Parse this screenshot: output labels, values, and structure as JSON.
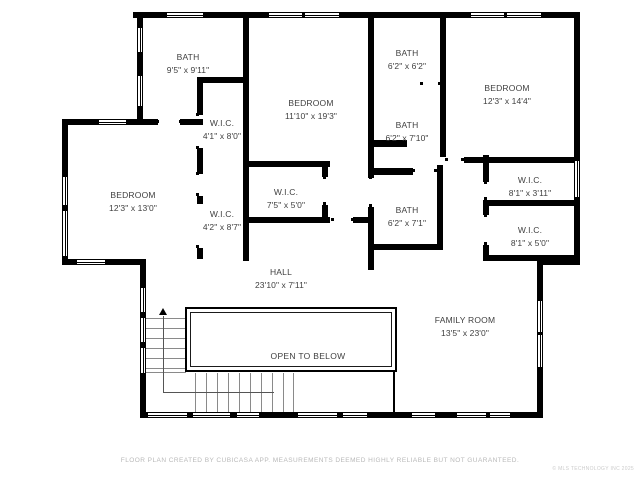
{
  "title": "Second floor plan",
  "colors": {
    "background": "#ffffff",
    "wall": "#000000",
    "label_text": "#3f3f3f",
    "footer_text": "#b9b9b9"
  },
  "rooms": [
    {
      "name": "BATH",
      "dims": "9'5\" x 9'11\"",
      "cx": 188,
      "cy": 64
    },
    {
      "name": "W.I.C.",
      "dims": "4'1\" x 8'0\"",
      "cx": 222,
      "cy": 130
    },
    {
      "name": "BEDROOM",
      "dims": "11'10\" x 19'3\"",
      "cx": 311,
      "cy": 110
    },
    {
      "name": "BATH",
      "dims": "6'2\" x 6'2\"",
      "cx": 407,
      "cy": 60
    },
    {
      "name": "BATH",
      "dims": "6'2\" x 7'10\"",
      "cx": 407,
      "cy": 132
    },
    {
      "name": "BEDROOM",
      "dims": "12'3\" x 14'4\"",
      "cx": 507,
      "cy": 95
    },
    {
      "name": "BEDROOM",
      "dims": "12'3\" x 13'0\"",
      "cx": 133,
      "cy": 202
    },
    {
      "name": "W.I.C.",
      "dims": "4'2\" x 8'7\"",
      "cx": 222,
      "cy": 221
    },
    {
      "name": "W.I.C.",
      "dims": "7'5\" x 5'0\"",
      "cx": 286,
      "cy": 199
    },
    {
      "name": "BATH",
      "dims": "6'2\" x 7'1\"",
      "cx": 407,
      "cy": 217
    },
    {
      "name": "W.I.C.",
      "dims": "8'1\" x 3'11\"",
      "cx": 530,
      "cy": 187
    },
    {
      "name": "W.I.C.",
      "dims": "8'1\" x 5'0\"",
      "cx": 530,
      "cy": 237
    },
    {
      "name": "HALL",
      "dims": "23'10\" x 7'11\"",
      "cx": 281,
      "cy": 279
    },
    {
      "name": "FAMILY ROOM",
      "dims": "13'5\" x 23'0\"",
      "cx": 465,
      "cy": 327
    }
  ],
  "open_to_below": {
    "label": "OPEN TO BELOW",
    "cx": 308,
    "cy": 356
  },
  "footer": {
    "disclaimer": "FLOOR PLAN CREATED BY CUBICASA APP. MEASUREMENTS DEEMED HIGHLY RELIABLE BUT NOT GUARANTEED.",
    "copyright": "© MLS TECHNOLOGY INC 2025"
  },
  "plan": {
    "walls": [
      [
        133,
        12,
        447,
        6
      ],
      [
        574,
        12,
        6,
        253
      ],
      [
        537,
        259,
        43,
        6
      ],
      [
        537,
        259,
        6,
        159
      ],
      [
        140,
        412,
        403,
        6
      ],
      [
        140,
        259,
        6,
        159
      ],
      [
        62,
        119,
        6,
        146
      ],
      [
        62,
        119,
        36,
        6
      ],
      [
        127,
        119,
        31,
        6
      ],
      [
        180,
        119,
        23,
        6
      ],
      [
        62,
        259,
        84,
        6
      ],
      [
        137,
        12,
        6,
        107
      ],
      [
        197,
        77,
        52,
        6
      ],
      [
        197,
        83,
        6,
        32
      ],
      [
        197,
        148,
        6,
        26
      ],
      [
        197,
        196,
        6,
        8
      ],
      [
        197,
        248,
        6,
        11
      ],
      [
        243,
        18,
        6,
        243
      ],
      [
        249,
        161,
        81,
        6
      ],
      [
        322,
        167,
        6,
        10
      ],
      [
        322,
        205,
        6,
        18
      ],
      [
        249,
        217,
        81,
        6
      ],
      [
        353,
        217,
        17,
        6
      ],
      [
        368,
        18,
        6,
        129
      ],
      [
        374,
        140,
        33,
        7
      ],
      [
        368,
        147,
        6,
        31
      ],
      [
        368,
        207,
        6,
        63
      ],
      [
        374,
        168,
        39,
        7
      ],
      [
        437,
        165,
        6,
        83
      ],
      [
        370,
        244,
        73,
        6
      ],
      [
        440,
        18,
        6,
        139
      ],
      [
        464,
        157,
        116,
        6
      ],
      [
        483,
        155,
        6,
        27
      ],
      [
        483,
        200,
        6,
        15
      ],
      [
        483,
        245,
        6,
        16
      ],
      [
        489,
        200,
        91,
        6
      ],
      [
        483,
        255,
        97,
        6
      ]
    ],
    "windows": [
      [
        166,
        12,
        38,
        6
      ],
      [
        268,
        12,
        35,
        6
      ],
      [
        304,
        12,
        36,
        6
      ],
      [
        470,
        12,
        35,
        6
      ],
      [
        506,
        12,
        36,
        6
      ],
      [
        137,
        27,
        6,
        26
      ],
      [
        137,
        75,
        6,
        32
      ],
      [
        98,
        119,
        29,
        6
      ],
      [
        62,
        176,
        6,
        30
      ],
      [
        62,
        210,
        6,
        47
      ],
      [
        76,
        259,
        30,
        6
      ],
      [
        140,
        287,
        6,
        26
      ],
      [
        140,
        317,
        6,
        26
      ],
      [
        140,
        347,
        6,
        27
      ],
      [
        574,
        160,
        6,
        38
      ],
      [
        537,
        300,
        6,
        33
      ],
      [
        537,
        334,
        6,
        34
      ],
      [
        147,
        412,
        41,
        6
      ],
      [
        192,
        412,
        39,
        6
      ],
      [
        236,
        412,
        24,
        6
      ],
      [
        297,
        412,
        41,
        6
      ],
      [
        342,
        412,
        26,
        6
      ],
      [
        411,
        412,
        25,
        6
      ],
      [
        456,
        412,
        31,
        6
      ],
      [
        489,
        412,
        22,
        6
      ]
    ],
    "dots": [
      [
        156,
        120
      ],
      [
        179,
        120
      ],
      [
        196,
        113
      ],
      [
        196,
        146
      ],
      [
        196,
        172
      ],
      [
        196,
        193
      ],
      [
        196,
        245
      ],
      [
        412,
        169
      ],
      [
        434,
        169
      ],
      [
        369,
        176
      ],
      [
        369,
        204
      ],
      [
        331,
        218
      ],
      [
        351,
        218
      ],
      [
        323,
        176
      ],
      [
        323,
        202
      ],
      [
        445,
        158
      ],
      [
        461,
        158
      ],
      [
        484,
        181
      ],
      [
        484,
        197
      ],
      [
        484,
        214
      ],
      [
        484,
        242
      ],
      [
        420,
        82
      ],
      [
        438,
        82
      ]
    ],
    "railing": {
      "outer": [
        185,
        307,
        212,
        65
      ],
      "inner": [
        190,
        312,
        202,
        55
      ],
      "right_bar": [
        393,
        372,
        2,
        41
      ]
    },
    "stairs": {
      "upper_treads_y": [
        318,
        328,
        338,
        348,
        358,
        368
      ],
      "upper_tread_x": 146,
      "upper_tread_w": 39,
      "lower_treads_x": [
        195,
        206,
        217,
        228,
        239,
        250,
        261,
        272,
        283,
        293
      ],
      "lower_tread_y": 373,
      "lower_tread_h": 39,
      "corner_line": [
        146,
        372,
        40,
        1
      ],
      "walkline_v": [
        163,
        316,
        1,
        77
      ],
      "walkline_h": [
        163,
        392,
        111,
        1
      ],
      "arrow": [
        159,
        308
      ]
    }
  }
}
